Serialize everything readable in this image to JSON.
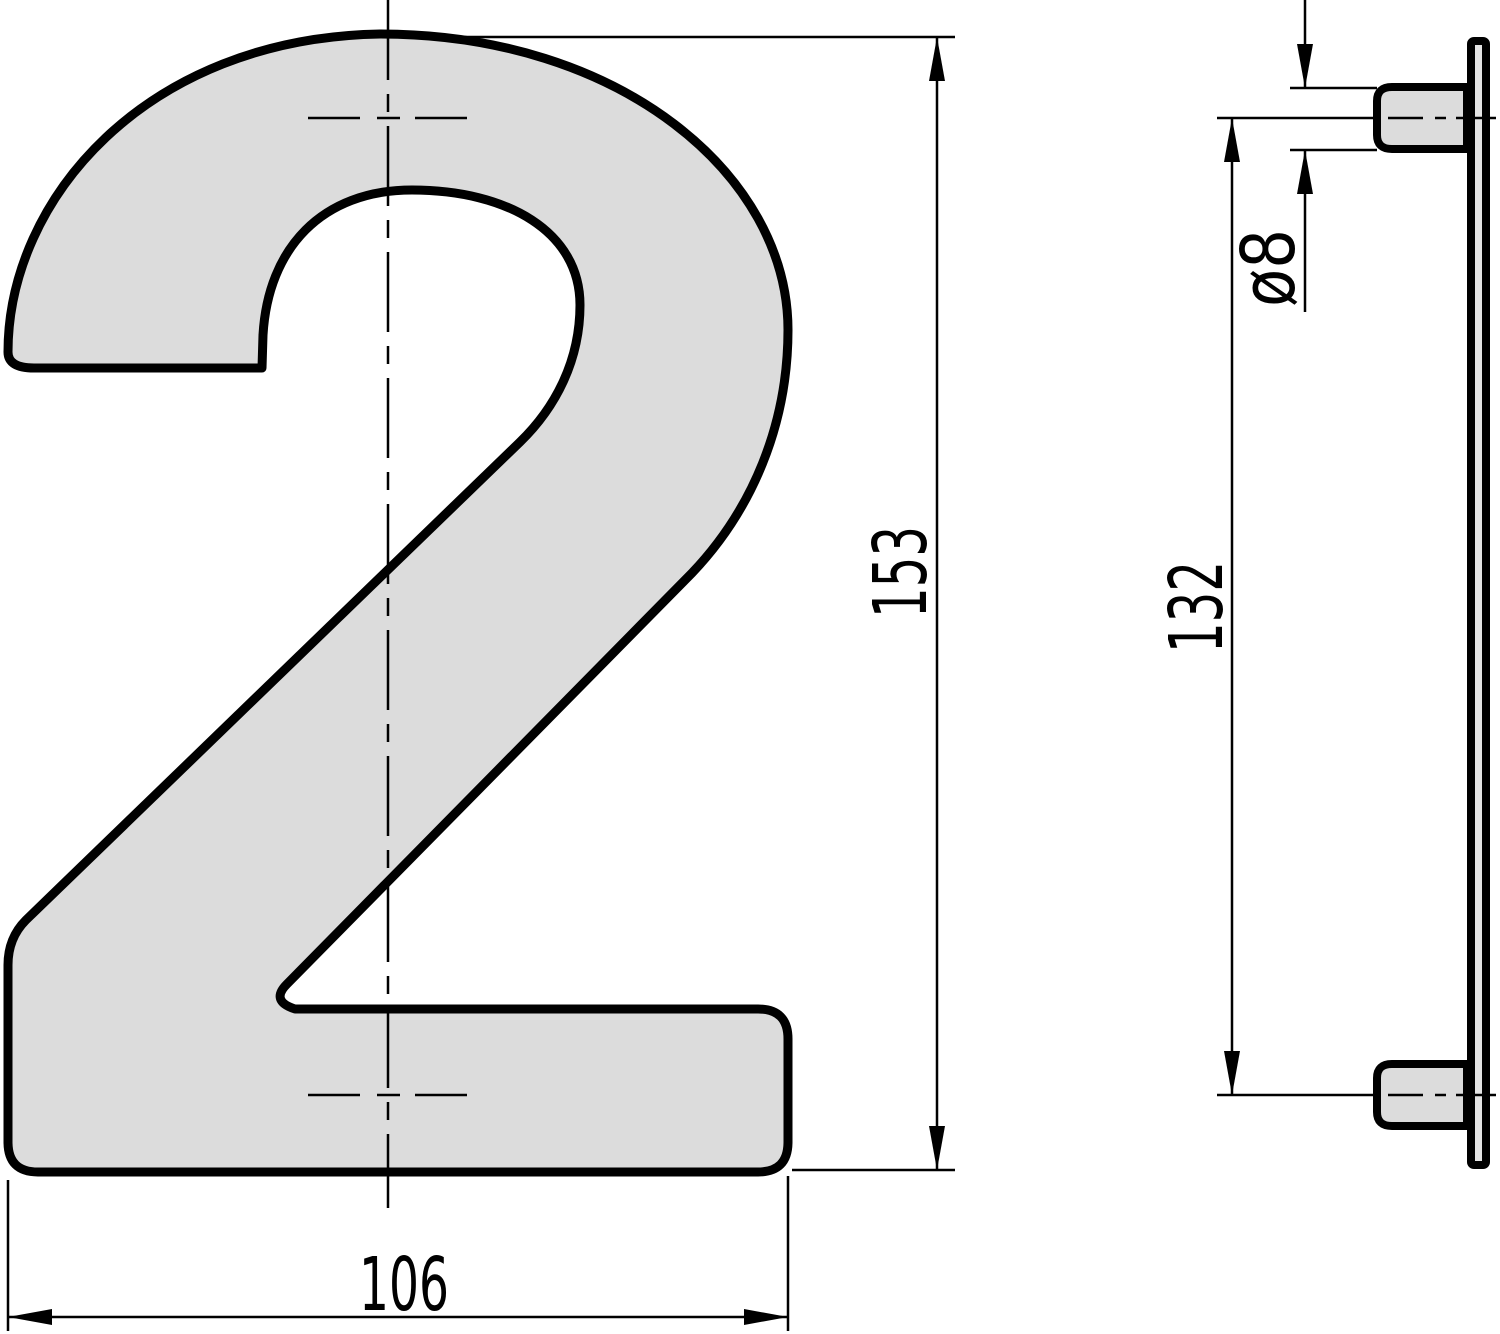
{
  "drawing": {
    "type": "technical-dimension-drawing",
    "front_view": {
      "numeral": "2",
      "dimensions": {
        "height": "153",
        "width": "106"
      }
    },
    "side_view": {
      "dimensions": {
        "peg_spacing": "132",
        "peg_diameter": "ø8"
      }
    },
    "colors": {
      "shape_fill": "#dcdcdc",
      "plate_fill": "#e4e4e4",
      "outline": "#000000",
      "thin_line": "#000000",
      "background": "#ffffff"
    }
  }
}
